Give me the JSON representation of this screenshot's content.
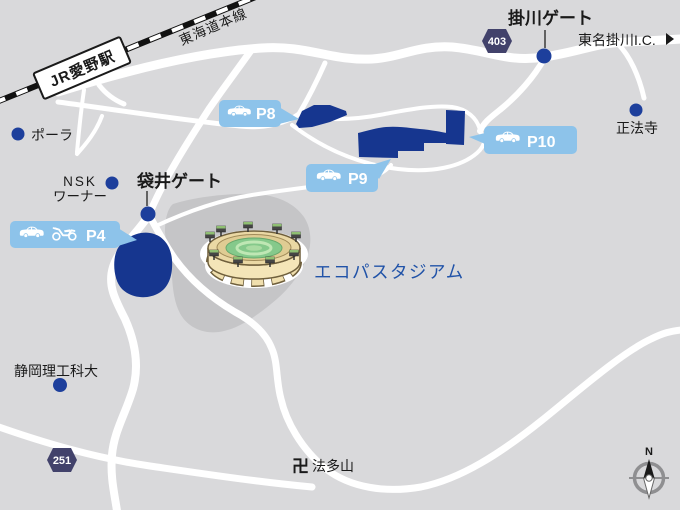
{
  "railway": {
    "station_label": "JR愛野駅",
    "line_label": "東海道本線"
  },
  "gates": {
    "kakegawa": "掛川ゲート",
    "fukuroi": "袋井ゲート"
  },
  "landmarks": {
    "pola": "ポーラ",
    "nsk_line1": "NSK",
    "nsk_line2": "ワーナー",
    "shoboji": "正法寺",
    "tomei_kakegawa_ic": "東名掛川I.C.",
    "university": "静岡理工科大",
    "hattasan_symbol": "卍",
    "hattasan": "法多山",
    "stadium": "エコパスタジアム"
  },
  "routes": {
    "route403": "403",
    "route251": "251"
  },
  "parking": {
    "p8": {
      "label": "P8",
      "icons": [
        "car-icon"
      ]
    },
    "p9": {
      "label": "P9",
      "icons": [
        "car-icon"
      ]
    },
    "p10": {
      "label": "P10",
      "icons": [
        "car-icon"
      ]
    },
    "p4": {
      "label": "P4",
      "icons": [
        "car-icon",
        "motorcycle-icon"
      ]
    }
  },
  "compass": {
    "north": "N"
  },
  "colors": {
    "background": "#d9d9db",
    "road": "#ffffff",
    "parking_fill": "#16368f",
    "marker_dot": "#1d3f9c",
    "callout_bg": "#8dc3ea",
    "callout_text": "#ffffff",
    "route_badge_bg": "#42426b",
    "stadium_label_text": "#2153a8",
    "map_text": "#1a1a1a",
    "stadium_grounds": "#c5c5c7",
    "railway_black": "#111111"
  }
}
